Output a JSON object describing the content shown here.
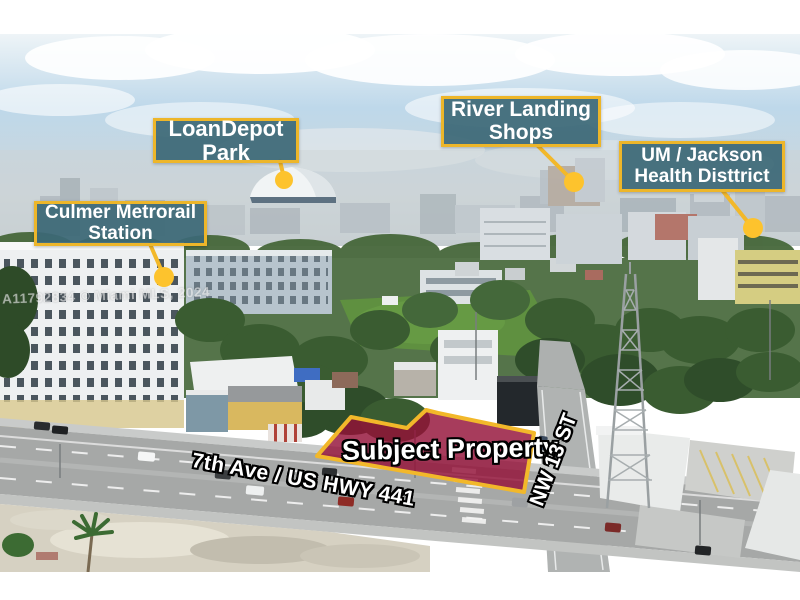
{
  "photo": {
    "description": "aerial-photo-of-miami-property"
  },
  "annotations": {
    "labels": [
      {
        "id": "loandepot-park",
        "line1": "LoanDepot",
        "line2": "Park"
      },
      {
        "id": "river-landing",
        "line1": "River Landing",
        "line2": "Shops"
      },
      {
        "id": "um-jackson",
        "line1": "UM / Jackson",
        "line2": "Health Disttrict"
      },
      {
        "id": "culmer-metrorail",
        "line1": "Culmer Metrorail",
        "line2": "Station"
      }
    ],
    "subject_property_label": "Subject Property",
    "street_labels": {
      "main": "7th Ave / US HWY 441",
      "cross": "NW 13 ST"
    },
    "watermark": "A11792834 © Miami MLS, 2024",
    "colors": {
      "label_bg": "rgba(60,104,118,0.93)",
      "label_border": "#edb62a",
      "marker": "#fdc32d",
      "leader_line": "#f2b82a",
      "property_fill": "rgba(148,17,56,0.82)",
      "property_stroke": "#f2b82a"
    }
  }
}
